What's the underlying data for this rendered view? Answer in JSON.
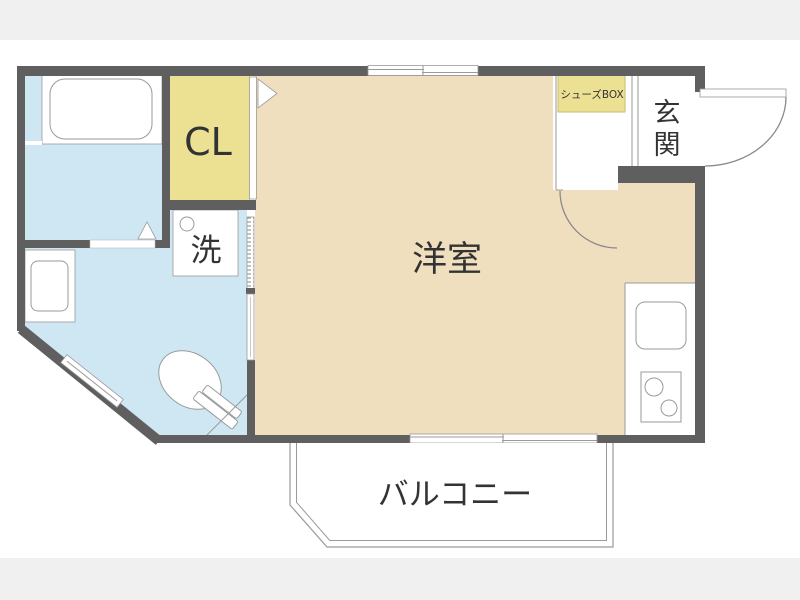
{
  "title": "apartment-floor-plan",
  "colors": {
    "wall": "#5f5f5f",
    "room-tan": "#f0dfbf",
    "room-blue": "#cfe7f3",
    "room-yellow": "#ece193",
    "line": "#9a9a9a",
    "text": "#333333",
    "page-strip": "#f0f0f1",
    "bg": "#ffffff"
  },
  "labels": {
    "western_room": "洋室",
    "closet": "CL",
    "laundry": "洗",
    "entrance": "玄関",
    "shoe_box": "シューズBOX",
    "balcony": "バルコニー"
  }
}
